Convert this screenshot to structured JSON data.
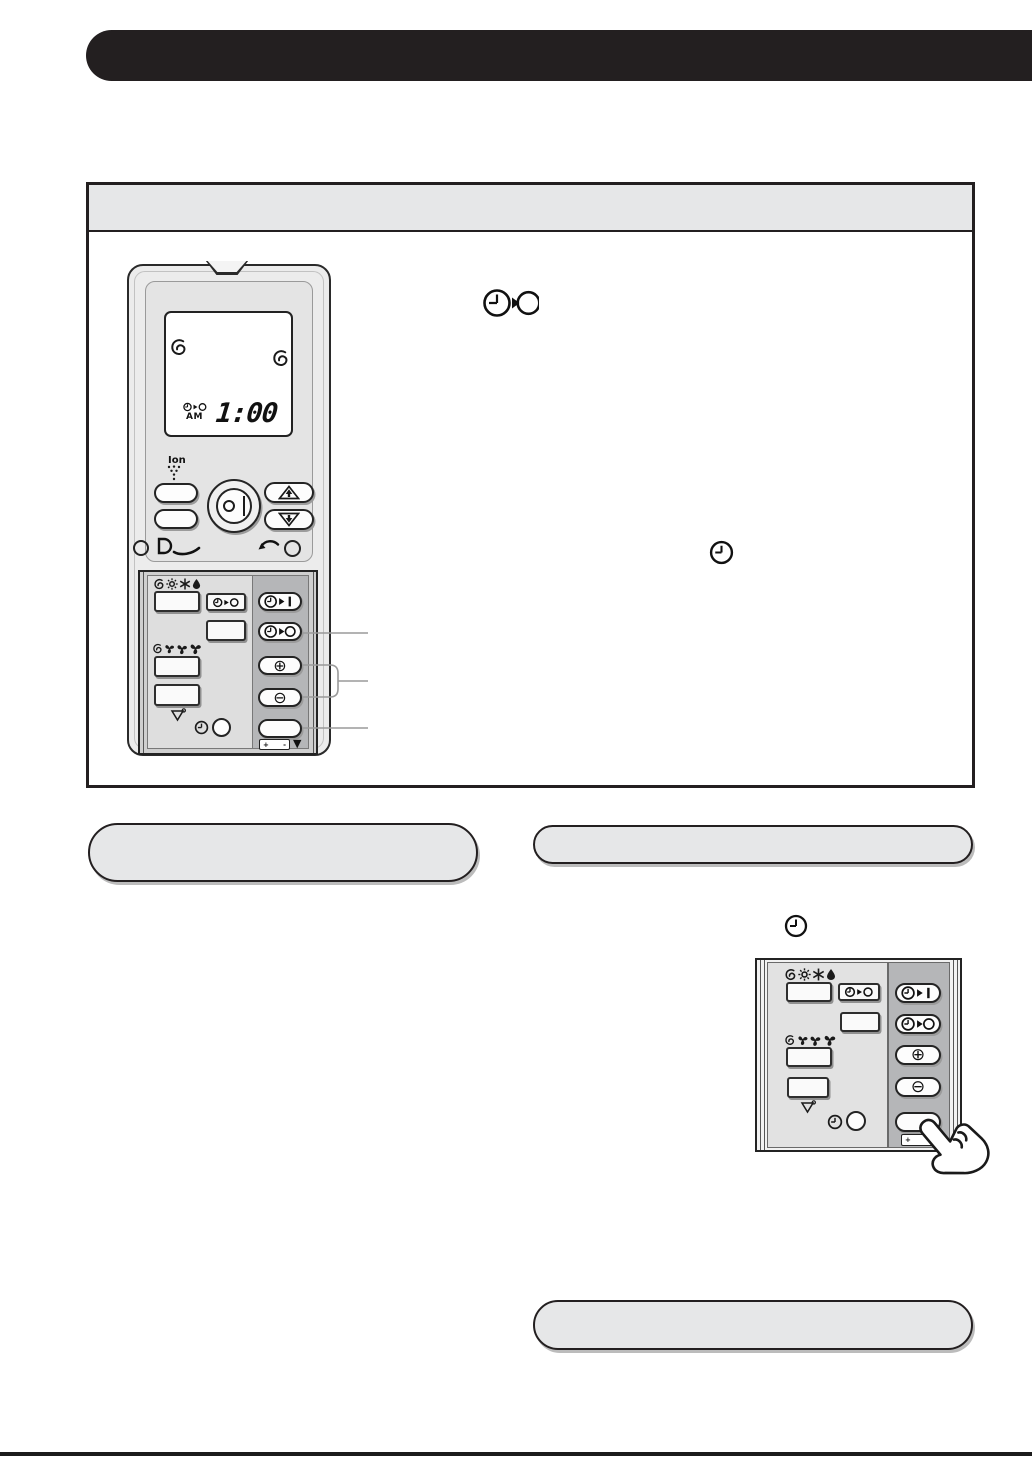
{
  "header": {
    "title": ""
  },
  "figure": {
    "remote": {
      "lcd": {
        "time": "1:00",
        "meridiem": "AM"
      },
      "ion_label": "Ion",
      "battery_plus": "+",
      "battery_minus": "-"
    },
    "callouts": {
      "left_box_text": "",
      "right_top_box_text": "",
      "right_bottom_box_text": ""
    }
  },
  "zoom_panel": {
    "battery_plus": "+",
    "battery_minus": "-"
  },
  "glyphs": {
    "plus_circled": "⊕",
    "minus_circled": "⊖",
    "triangle_down": "▼"
  },
  "colors": {
    "header_bar": "#231f20",
    "box_border": "#231f20",
    "gray_fill": "#e6e7e8",
    "panel_light_gray": "#dedede",
    "panel_dark_gray": "#b5b6b8",
    "leader_line_gray": "#9a9a9a"
  }
}
